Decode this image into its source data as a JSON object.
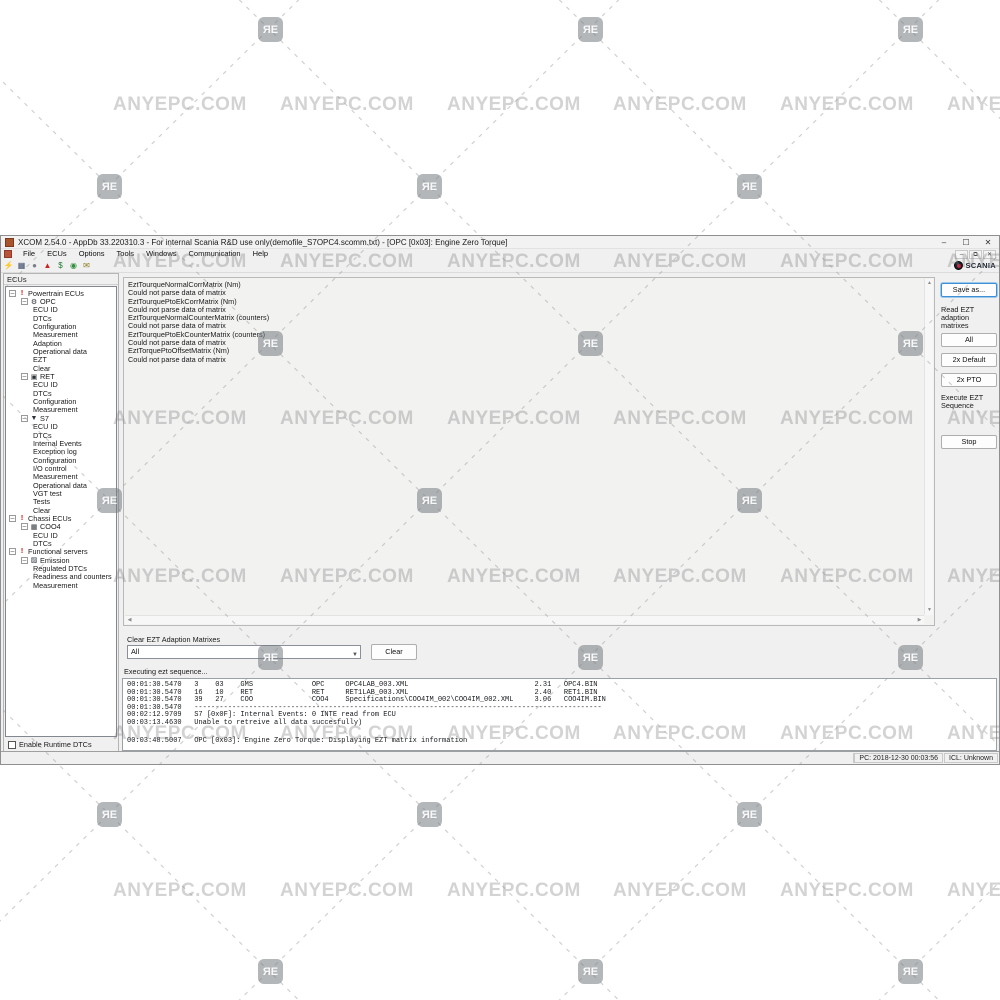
{
  "window": {
    "title": "XCOM 2.54.0 - AppDb 33.220310.3 - For internal Scania R&D use only(demofile_S7OPC4.scomm.txt) - [OPC [0x03]: Engine Zero Torque]",
    "controls": {
      "minimize": "–",
      "maximize": "☐",
      "close": "✕"
    },
    "mdi_controls": {
      "minimize": "–",
      "restore": "⧉",
      "close": "✕"
    }
  },
  "menu": {
    "items": [
      "File",
      "ECUs",
      "Options",
      "Tools",
      "Windows",
      "Communication",
      "Help"
    ]
  },
  "toolbar": {
    "icons": [
      {
        "name": "connect-icon",
        "glyph": "⚡",
        "color": "#c2352b"
      },
      {
        "name": "save-icon",
        "glyph": "▦",
        "color": "#3a4a66"
      },
      {
        "name": "print-icon",
        "glyph": "●",
        "color": "#7a7f85"
      },
      {
        "name": "warning-icon",
        "glyph": "▲",
        "color": "#cc2222"
      },
      {
        "name": "dollar-icon",
        "glyph": "$",
        "color": "#1b7a2f"
      },
      {
        "name": "help-icon",
        "glyph": "◉",
        "color": "#2f8f3a"
      },
      {
        "name": "mail-icon",
        "glyph": "✉",
        "color": "#8a7a1a"
      }
    ],
    "brand": "SCANIA"
  },
  "sidebar": {
    "header": "ECUs",
    "checkbox_label": "Enable Runtime DTCs",
    "tree": [
      {
        "label": "Powertrain ECUs",
        "level": 0,
        "icon": "exclamation-icon",
        "expandable": true
      },
      {
        "label": "OPC",
        "level": 1,
        "icon": "gear-icon",
        "expandable": true
      },
      {
        "label": "ECU ID",
        "level": 2
      },
      {
        "label": "DTCs",
        "level": 2
      },
      {
        "label": "Configuration",
        "level": 2
      },
      {
        "label": "Measurement",
        "level": 2
      },
      {
        "label": "Adaption",
        "level": 2
      },
      {
        "label": "Operational data",
        "level": 2
      },
      {
        "label": "EZT",
        "level": 2
      },
      {
        "label": "Clear",
        "level": 2
      },
      {
        "label": "RET",
        "level": 1,
        "icon": "retarder-icon",
        "expandable": true
      },
      {
        "label": "ECU ID",
        "level": 2
      },
      {
        "label": "DTCs",
        "level": 2
      },
      {
        "label": "Configuration",
        "level": 2
      },
      {
        "label": "Measurement",
        "level": 2
      },
      {
        "label": "S7",
        "level": 1,
        "icon": "s7-icon",
        "expandable": true
      },
      {
        "label": "ECU ID",
        "level": 2
      },
      {
        "label": "DTCs",
        "level": 2
      },
      {
        "label": "Internal Events",
        "level": 2
      },
      {
        "label": "Exception log",
        "level": 2
      },
      {
        "label": "Configuration",
        "level": 2
      },
      {
        "label": "I/O control",
        "level": 2
      },
      {
        "label": "Measurement",
        "level": 2
      },
      {
        "label": "Operational data",
        "level": 2
      },
      {
        "label": "VGT test",
        "level": 2
      },
      {
        "label": "Tests",
        "level": 2
      },
      {
        "label": "Clear",
        "level": 2
      },
      {
        "label": "Chassi ECUs",
        "level": 0,
        "icon": "exclamation-icon",
        "expandable": true
      },
      {
        "label": "COO4",
        "level": 1,
        "icon": "coo4-icon",
        "expandable": true
      },
      {
        "label": "ECU ID",
        "level": 2
      },
      {
        "label": "DTCs",
        "level": 2
      },
      {
        "label": "Functional servers",
        "level": 0,
        "icon": "exclamation-icon",
        "expandable": true
      },
      {
        "label": "Emission",
        "level": 1,
        "icon": "emission-icon",
        "expandable": true
      },
      {
        "label": "Regulated DTCs",
        "level": 2
      },
      {
        "label": "Readiness and counters",
        "level": 2
      },
      {
        "label": "Measurement",
        "level": 2
      }
    ]
  },
  "main": {
    "matrix_lines": [
      "EztTourqueNormalCorrMatrix (Nm)",
      "Could not parse data of matrix",
      "EztTourquePtoEkCorrMatrix (Nm)",
      "Could not parse data of matrix",
      "EztTourqueNormalCounterMatrix (counters)",
      "Could not parse data of matrix",
      "EztTourquePtoEkCounterMatrix (counters)",
      "Could not parse data of matrix",
      "EztTorquePtoOffsetMatrix (Nm)",
      "Could not parse data of matrix"
    ],
    "right_panel": {
      "save_as": "Save as...",
      "read_label": "Read EZT\nadaption\nmatrixes",
      "all": "All",
      "default2x": "2x Default",
      "pto2x": "2x PTO",
      "execute_label": "Execute EZT\nSequence",
      "stop": "Stop"
    },
    "clear_section": {
      "label": "Clear EZT Adaption Matrixes",
      "dropdown_value": "All",
      "clear_button": "Clear"
    },
    "executing_label": "Executing ezt sequence...",
    "log_lines": [
      "00:01:30.5470   3    03    GMS              OPC     OPC4LAB_003.XML                              2.31   OPC4.BIN",
      "00:01:30.5470   16   10    RET              RET     RET1LAB_003.XML                              2.40   RET1.BIN",
      "00:01:30.5470   39   27    COO              COO4    Specifications\\COO4IM_002\\COO4IM_002.XML     3.06   COO4IM.BIN",
      "00:01:30.5470   -------------------------------------------------------------------------------------------------",
      "00:02:12.9709   S7 [0x0F]: Internal Events: 0 INTE read from ECU",
      "00:03:13.4630   Unable to retreive all data succesfully)"
    ],
    "log_selected": "00:03:48.5007   OPC [0x03]: Engine Zero Torque: Displaying EZT matrix information"
  },
  "statusbar": {
    "pc": "PC: 2018-12-30 00:03:56",
    "icl": "ICL: Unknown"
  },
  "watermark": {
    "text": "ANYEPC.COM",
    "badge": "ЯЕ"
  }
}
